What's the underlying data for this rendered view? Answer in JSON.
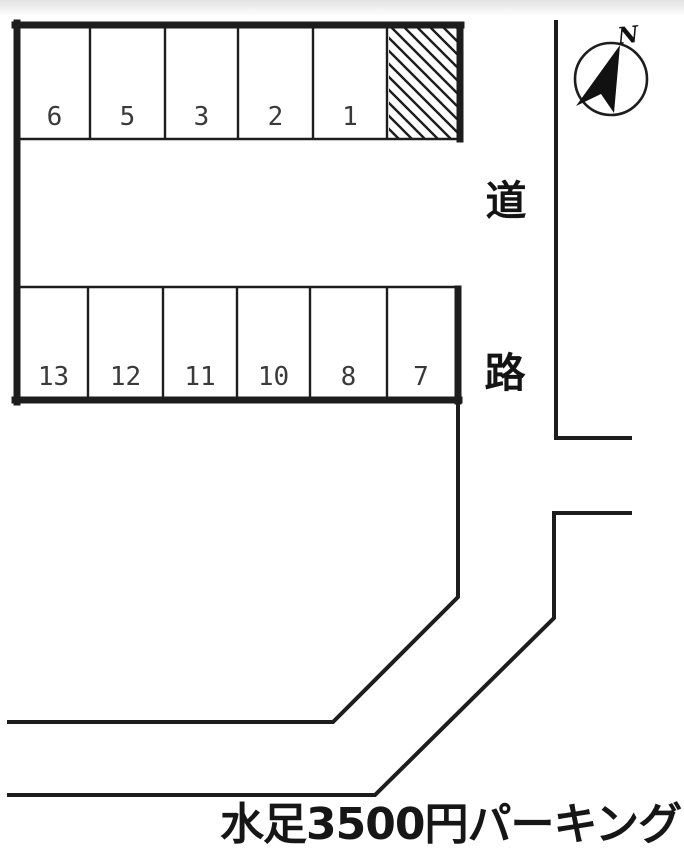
{
  "title": "水足3500円パーキング",
  "compass": {
    "north_label": "N",
    "icon": "north-arrow-compass-icon"
  },
  "road": {
    "label_top": "道",
    "label_bottom": "路"
  },
  "parking": {
    "top_row_spaces": [
      "6",
      "5",
      "3",
      "2",
      "1"
    ],
    "bottom_row_spaces": [
      "13",
      "12",
      "11",
      "10",
      "8",
      "7"
    ],
    "hatched_area": "diagonal-hatch-no-parking"
  },
  "colors": {
    "line": "#1d1d1d",
    "background": "#ffffff",
    "number_text": "#3a3a3a"
  }
}
